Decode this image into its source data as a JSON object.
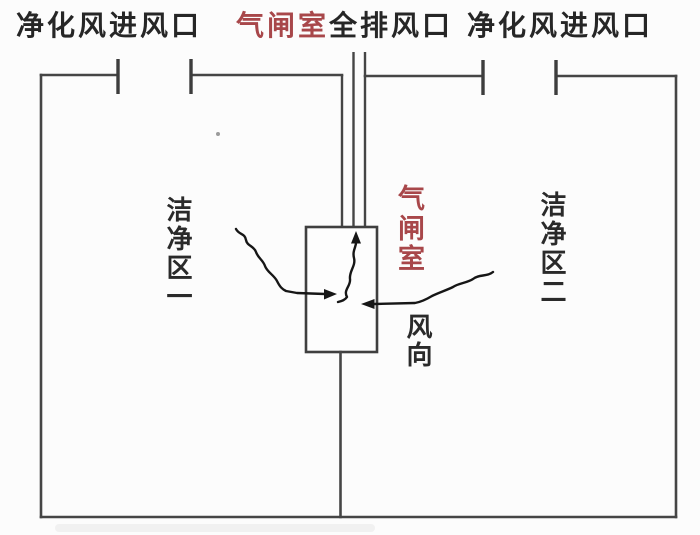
{
  "diagram": {
    "top_labels": {
      "left": "净化风进风口",
      "center_red": "气闸室",
      "center_black": "全排风口",
      "right": "净化风进风口"
    },
    "zone_labels": {
      "left": "洁净区一",
      "right": "洁净区二"
    },
    "airlock_label": "气闸室",
    "wind_label": "风向",
    "colors": {
      "wall_line": "#454545",
      "arrow_line": "#161616",
      "text": "#262626",
      "accent_red": "#a8474a",
      "background": "#fcfcfc"
    }
  }
}
